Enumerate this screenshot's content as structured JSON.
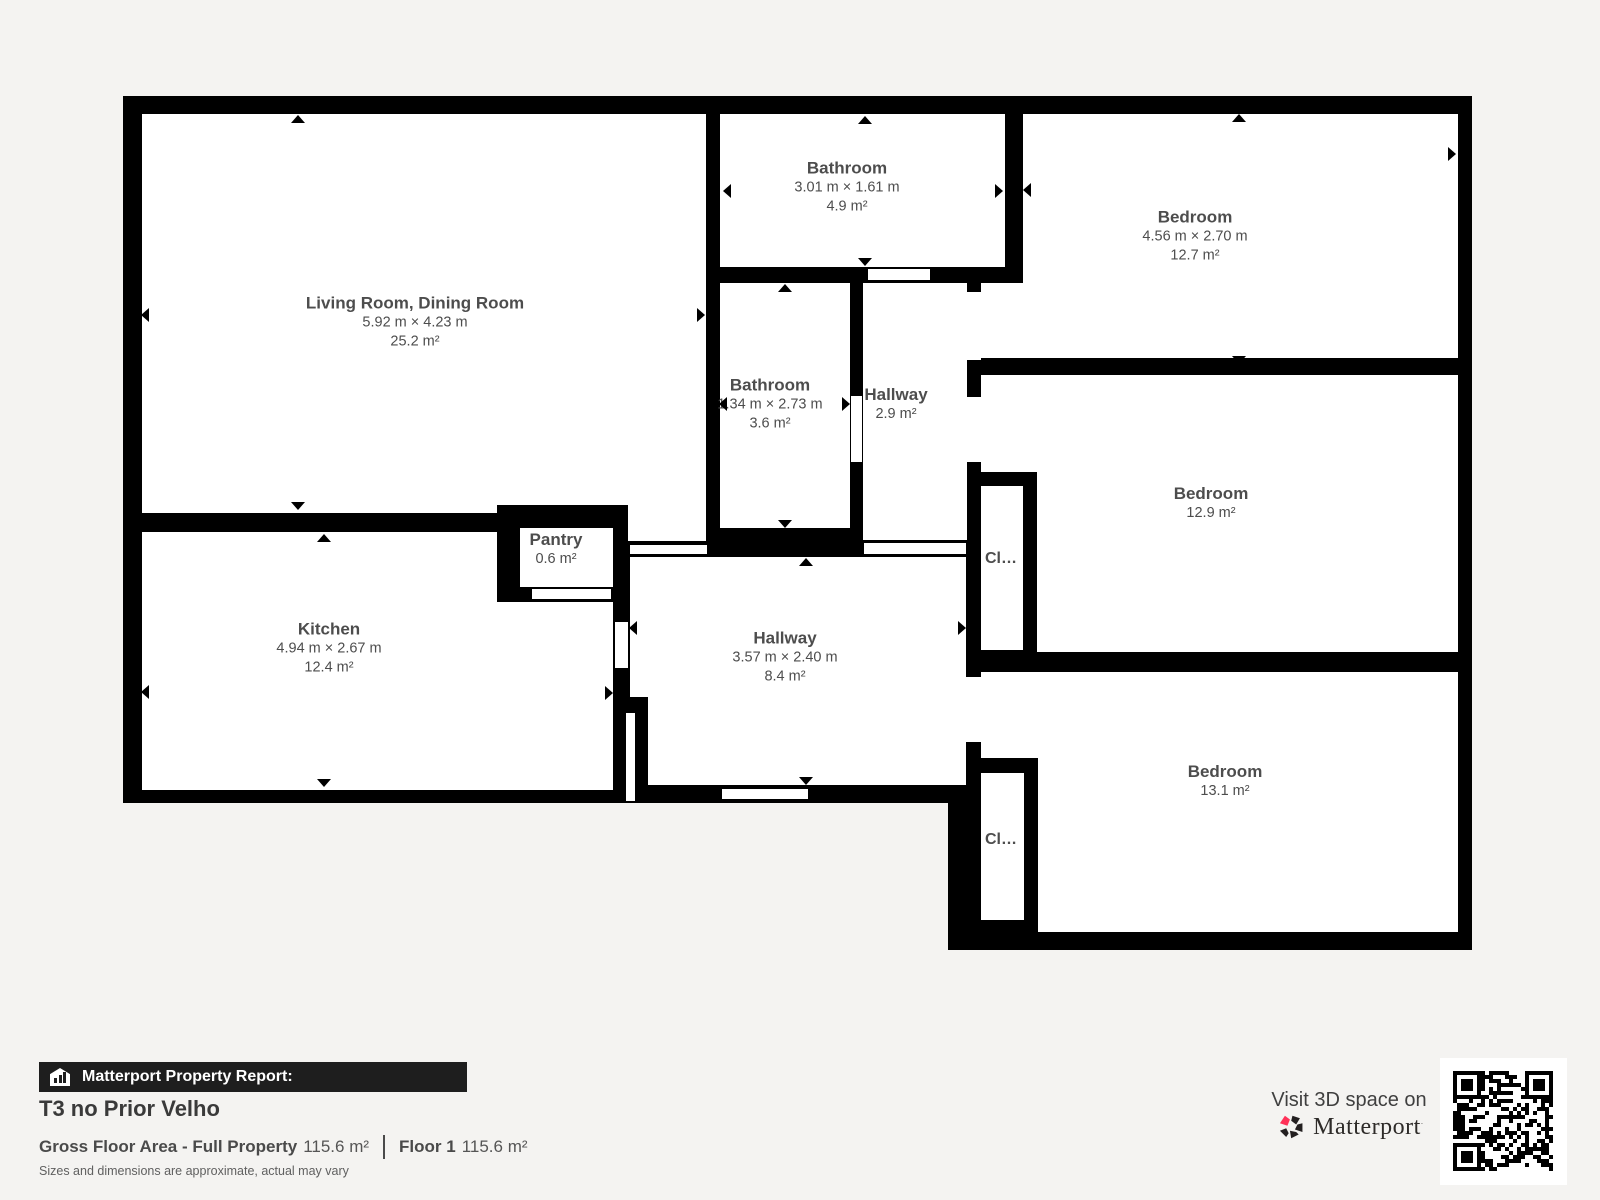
{
  "page": {
    "background": "#f4f3f1",
    "wall_color": "#000000",
    "room_fill": "#ffffff",
    "label_color": "#4d4d4d"
  },
  "plan": {
    "rooms": {
      "living": {
        "name": "Living Room, Dining Room",
        "dims": "5.92 m × 4.23 m",
        "area": "25.2 m²"
      },
      "bathroom_top": {
        "name": "Bathroom",
        "dims": "3.01 m × 1.61 m",
        "area": "4.9 m²"
      },
      "bedroom_top": {
        "name": "Bedroom",
        "dims": "4.56 m × 2.70 m",
        "area": "12.7 m²"
      },
      "bathroom_mid": {
        "name": "Bathroom",
        "dims": "1.34 m × 2.73 m",
        "area": "3.6 m²"
      },
      "hallway_small": {
        "name": "Hallway",
        "area": "2.9 m²"
      },
      "bedroom_mid": {
        "name": "Bedroom",
        "area": "12.9 m²"
      },
      "kitchen": {
        "name": "Kitchen",
        "dims": "4.94 m × 2.67 m",
        "area": "12.4 m²"
      },
      "pantry": {
        "name": "Pantry",
        "area": "0.6 m²"
      },
      "hallway_main": {
        "name": "Hallway",
        "dims": "3.57 m × 2.40 m",
        "area": "8.4 m²"
      },
      "bedroom_bottom": {
        "name": "Bedroom",
        "area": "13.1 m²"
      },
      "closet_1": {
        "name": "Cl…"
      },
      "closet_2": {
        "name": "Cl…"
      }
    }
  },
  "footer": {
    "report_label": "Matterport Property Report:",
    "property_title": "T3 no Prior Velho",
    "gross_label": "Gross Floor Area - Full Property",
    "gross_value": "115.6 m²",
    "floor_label": "Floor 1",
    "floor_value": "115.6 m²",
    "disclaimer": "Sizes and dimensions are approximate, actual may vary"
  },
  "branding": {
    "visit_text": "Visit 3D space on",
    "brand": "Matterport",
    "accent_color": "#ff3158"
  }
}
